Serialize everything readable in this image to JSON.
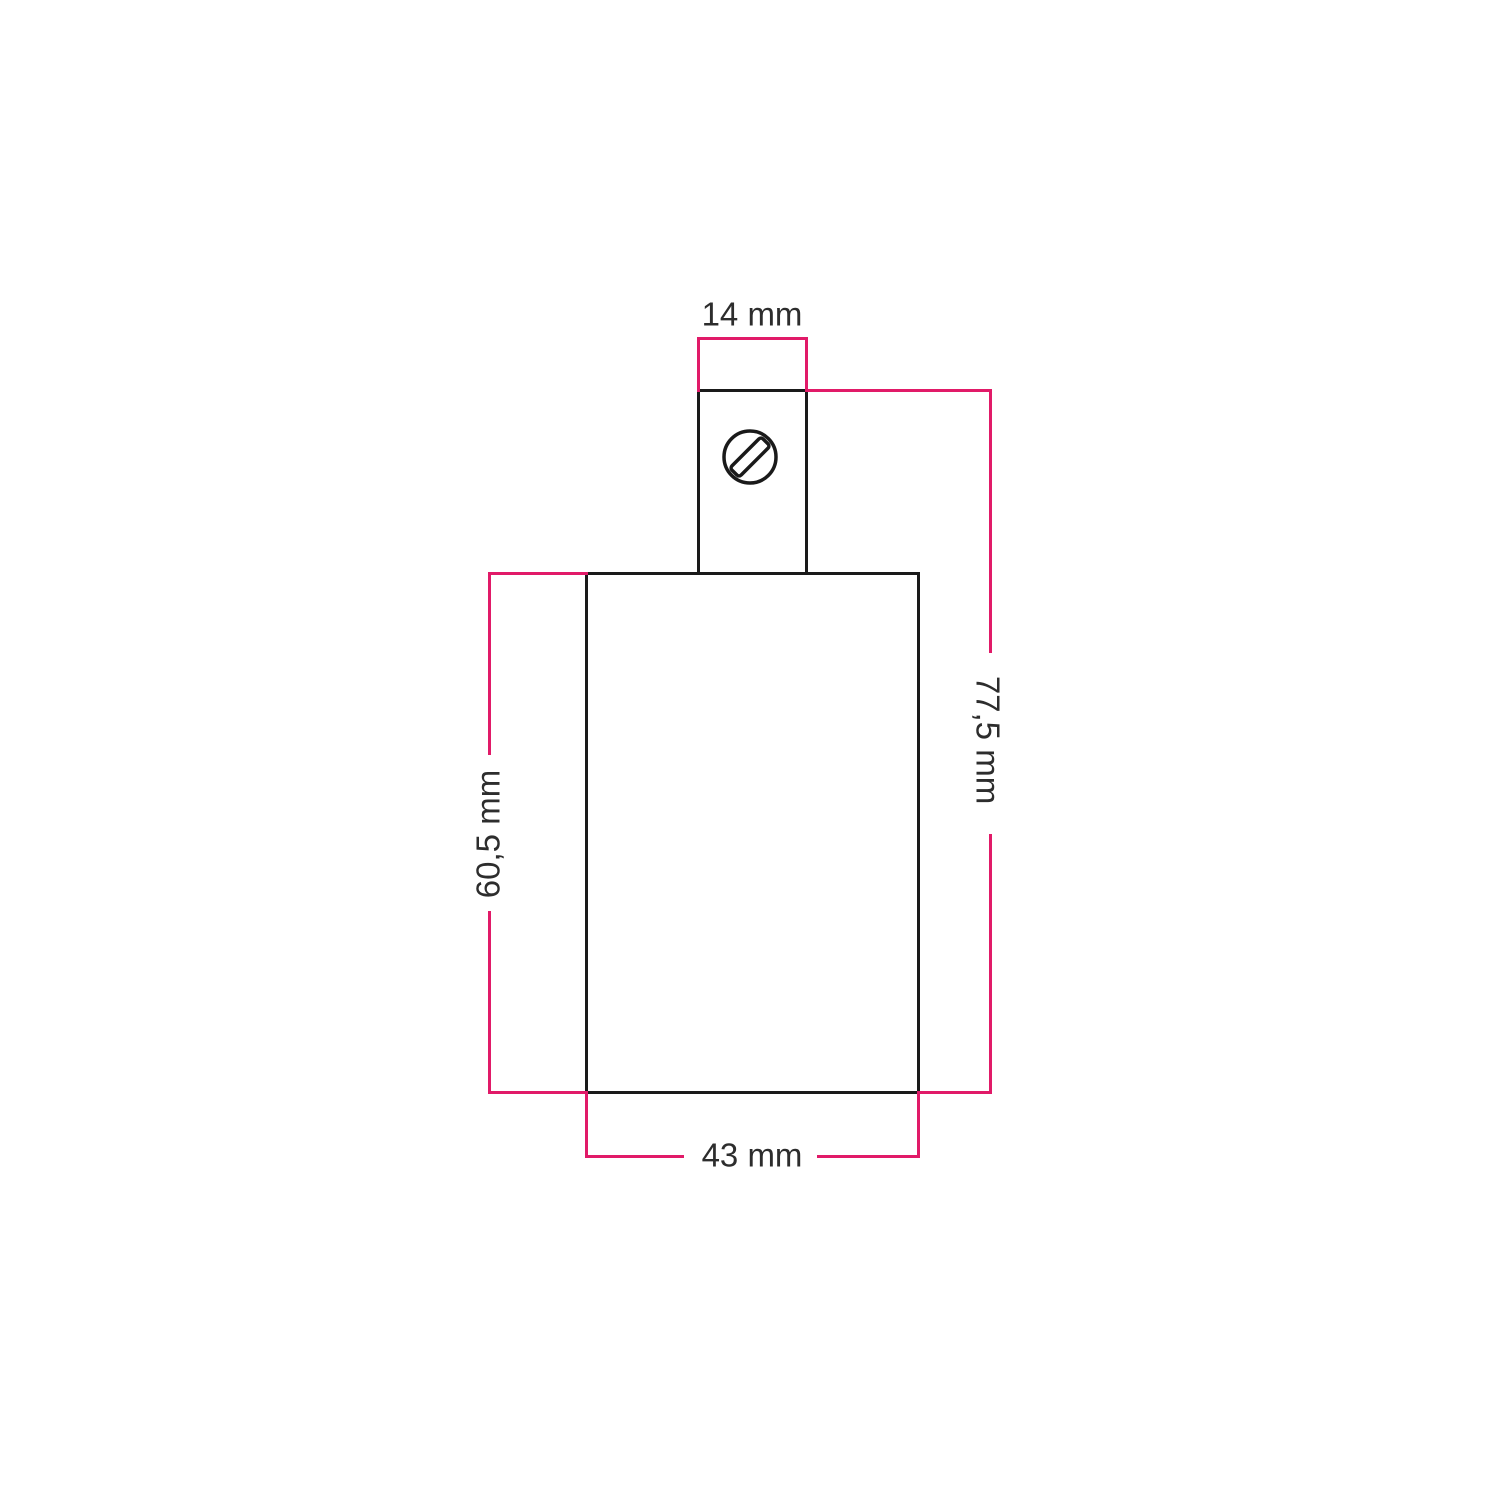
{
  "colors": {
    "dimension": "#e11a68",
    "outline": "#1a1a1a",
    "text": "#2d2d2d",
    "background": "#ffffff"
  },
  "labels": {
    "top_width": "14 mm",
    "total_height": "77,5 mm",
    "body_height": "60,5 mm",
    "body_width": "43 mm"
  },
  "icons": {
    "screw": "slotted-screw-icon"
  }
}
